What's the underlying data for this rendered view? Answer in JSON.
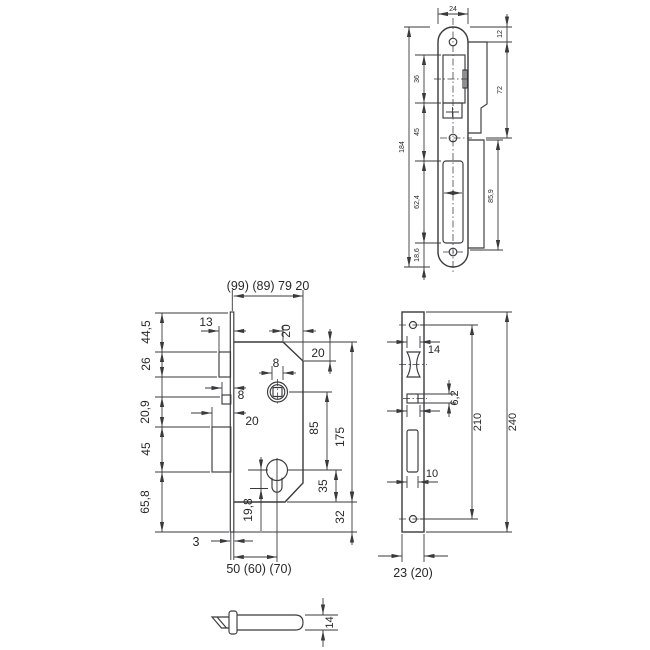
{
  "drawing": {
    "background": "#ffffff",
    "line_color": "#3a3a3d",
    "text_color": "#28282b",
    "views": {
      "strike_plate": {
        "name": "Strike plate side view",
        "dim_width": "24",
        "dim_top_to_hole": "12",
        "dim_hole_to_hole": "72",
        "dim_latch_cutout": "36",
        "dim_latch_to_bolt": "45",
        "dim_bolt_cutout": "62,4",
        "dim_bolt_to_end": "18,6",
        "dim_total_height": "184",
        "dim_lip_height": "85,9"
      },
      "lock_body": {
        "name": "Lock body side view",
        "dim_depth": "(99) (89) 79 20",
        "dim_latch_protrusion": "13",
        "dim_chamfer_width": "20",
        "dim_chamfer_height": "20",
        "dim_follower_square": "8",
        "dim_aux_protrusion": "8",
        "dim_deadbolt_throw": "20",
        "dim_seg_top": "44,5",
        "dim_seg_latch": "26",
        "dim_seg_mid": "20,9",
        "dim_seg_deadbolt": "45",
        "dim_seg_bottom": "65,8",
        "dim_follower_to_cylinder": "85",
        "dim_body_height": "175",
        "dim_cylinder_to_bottom": "35",
        "dim_faceplate_overhang": "32",
        "dim_cylinder_length": "19,8",
        "dim_faceplate_thickness": "3",
        "dim_backset": "50 (60) (70)"
      },
      "faceplate": {
        "name": "Faceplate front view",
        "dim_latch_width": "14",
        "dim_square_height": "6,2",
        "dim_bolt_width": "10",
        "dim_hole_spacing": "210",
        "dim_length": "240",
        "dim_width": "23 (20)"
      },
      "latch_bolt": {
        "name": "Latch bolt side view",
        "dim_height": "14"
      }
    }
  }
}
